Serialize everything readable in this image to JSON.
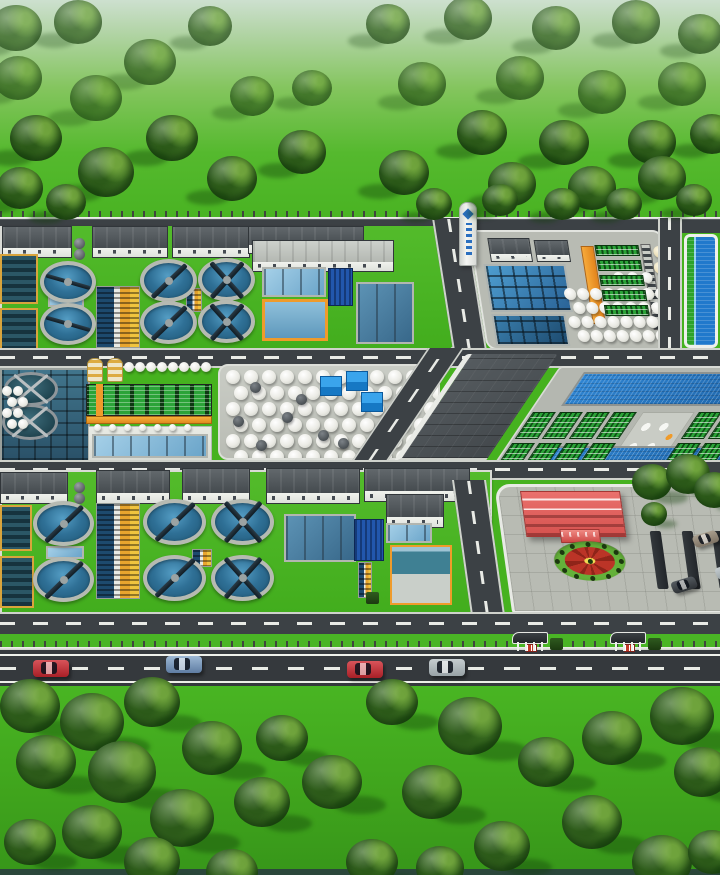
{
  "subject": "aerial 3d rendering of a wastewater treatment plant campus with tree belts, roads and vehicles",
  "colors": {
    "grass": "#46b21f",
    "grass_haze": "#cde0cf",
    "tree_dark": "#27511a",
    "tree_mid": "#4b8527",
    "tree_light": "#6fa33c",
    "road": "#3c4145",
    "road_dark": "#35393d",
    "curb": "#d6d8d3",
    "lane_marking": "#eef0ea",
    "water_clarifier": "#2f7096",
    "water_mid": "#6aa4c9",
    "water_teal": "#2a5168",
    "water_navy": "#2257ac",
    "rim": "#b6bab2",
    "bridge": "#101c24",
    "wall": "#eceee9",
    "roof_dark": "#454b4f",
    "roof_light": "#b4b8b2",
    "orange": "#ef9b2b",
    "yellow": "#f0c43e",
    "rack_green": "#2ba338",
    "tank": "#f3f3ee",
    "cube_blue": "#1678c4",
    "red_building": "#d6524f",
    "plaza": "#b8bbb3",
    "flower_red": "#bb3427",
    "flower_yellow": "#f0dc55",
    "flower_green": "#64b13a",
    "reservoir": "#2079cc",
    "reservoir_green": "#2ca32c",
    "car_red": "#a81f26",
    "car_blue": "#5f7da3",
    "car_silver": "#98a2a6",
    "car_dark": "#2e3236",
    "car_taupe": "#7e7365"
  },
  "scene": {
    "trees": [
      [
        16,
        28,
        26,
        "sw"
      ],
      [
        78,
        22,
        24,
        "sw"
      ],
      [
        210,
        26,
        22,
        "sw"
      ],
      [
        150,
        62,
        26,
        "sw"
      ],
      [
        18,
        78,
        24,
        "sw"
      ],
      [
        96,
        98,
        26,
        "sw"
      ],
      [
        252,
        96,
        22,
        "sw"
      ],
      [
        312,
        88,
        20,
        "sw"
      ],
      [
        36,
        138,
        26,
        "sw"
      ],
      [
        172,
        138,
        26,
        "sw"
      ],
      [
        106,
        172,
        28,
        "sw"
      ],
      [
        302,
        152,
        24,
        "sw"
      ],
      [
        232,
        178,
        25,
        "sw"
      ],
      [
        20,
        188,
        23,
        "sw"
      ],
      [
        66,
        202,
        20,
        "sw"
      ],
      [
        388,
        24,
        22,
        "sw"
      ],
      [
        468,
        18,
        24,
        "sw"
      ],
      [
        556,
        28,
        24,
        "sw"
      ],
      [
        636,
        22,
        24,
        "sw"
      ],
      [
        700,
        34,
        22,
        "sw"
      ],
      [
        422,
        84,
        24,
        "sw"
      ],
      [
        520,
        78,
        24,
        "sw"
      ],
      [
        602,
        92,
        24,
        "sw"
      ],
      [
        682,
        84,
        24,
        "sw"
      ],
      [
        482,
        132,
        25,
        "sw"
      ],
      [
        564,
        142,
        25,
        "sw"
      ],
      [
        652,
        142,
        24,
        "sw"
      ],
      [
        712,
        134,
        22,
        "sw"
      ],
      [
        404,
        172,
        25,
        "sw"
      ],
      [
        512,
        184,
        24,
        "sw"
      ],
      [
        592,
        188,
        24,
        "sw"
      ],
      [
        662,
        178,
        24,
        "sw"
      ],
      [
        434,
        204,
        18,
        "sw"
      ],
      [
        500,
        200,
        18,
        "sw"
      ],
      [
        562,
        204,
        18,
        "sw"
      ],
      [
        624,
        204,
        18,
        "sw"
      ],
      [
        694,
        200,
        18,
        "sw"
      ],
      [
        652,
        482,
        20,
        "se"
      ],
      [
        688,
        474,
        22,
        "se"
      ],
      [
        714,
        490,
        20,
        "se"
      ],
      [
        654,
        514,
        13,
        "se"
      ],
      [
        30,
        706,
        30,
        "se"
      ],
      [
        92,
        722,
        32,
        "se"
      ],
      [
        152,
        702,
        28,
        "se"
      ],
      [
        46,
        762,
        30,
        "se"
      ],
      [
        122,
        772,
        34,
        "se"
      ],
      [
        212,
        748,
        30,
        "se"
      ],
      [
        282,
        738,
        26,
        "se"
      ],
      [
        182,
        818,
        32,
        "se"
      ],
      [
        92,
        832,
        30,
        "se"
      ],
      [
        262,
        802,
        28,
        "se"
      ],
      [
        332,
        782,
        30,
        "se"
      ],
      [
        30,
        842,
        26,
        "se"
      ],
      [
        152,
        862,
        28,
        "se"
      ],
      [
        392,
        702,
        26,
        "se"
      ],
      [
        470,
        726,
        32,
        "se"
      ],
      [
        432,
        792,
        30,
        "se"
      ],
      [
        546,
        762,
        28,
        "se"
      ],
      [
        612,
        738,
        30,
        "se"
      ],
      [
        682,
        716,
        32,
        "se"
      ],
      [
        702,
        772,
        28,
        "se"
      ],
      [
        592,
        822,
        30,
        "se"
      ],
      [
        502,
        846,
        28,
        "se"
      ],
      [
        662,
        862,
        30,
        "se"
      ],
      [
        372,
        862,
        26,
        "se"
      ],
      [
        712,
        852,
        24,
        "se"
      ],
      [
        232,
        872,
        26,
        "se"
      ],
      [
        440,
        868,
        24,
        "se"
      ]
    ],
    "clarifiers": [
      [
        40,
        261,
        56,
        42,
        "h"
      ],
      [
        40,
        303,
        56,
        42,
        "h"
      ],
      [
        140,
        259,
        57,
        43,
        "diag"
      ],
      [
        140,
        301,
        57,
        43,
        "diag"
      ],
      [
        198,
        258,
        57,
        43,
        "x"
      ],
      [
        198,
        300,
        57,
        43,
        "x"
      ],
      [
        33,
        501,
        61,
        45,
        "diag"
      ],
      [
        33,
        557,
        61,
        45,
        "diag"
      ],
      [
        143,
        499,
        63,
        46,
        "diag"
      ],
      [
        143,
        555,
        63,
        46,
        "diag"
      ],
      [
        211,
        499,
        63,
        46,
        "x"
      ],
      [
        211,
        555,
        63,
        46,
        "x"
      ]
    ],
    "digesters": [
      [
        4,
        372,
        54,
        34
      ],
      [
        2,
        404,
        56,
        36
      ]
    ],
    "tank_grids": [
      {
        "parent": "tank-farm",
        "x": 6,
        "y": 4,
        "cols": 12,
        "rows": 6,
        "dx": 18,
        "dy": 16,
        "d": 14,
        "st": 8
      },
      {
        "parent": "process-yard",
        "x": 84,
        "y": 56,
        "cols": 8,
        "rows": 4,
        "dx": 13,
        "dy": 14,
        "d": 12,
        "st": 7
      },
      {
        "parent": "process-yard",
        "x": 136,
        "y": 40,
        "cols": 3,
        "rows": 1,
        "dx": 14,
        "dy": 0,
        "d": 11,
        "st": 0
      },
      {
        "parent": "scene",
        "x": 124,
        "y": 362,
        "cols": 8,
        "rows": 1,
        "dx": 11,
        "dy": 0,
        "d": 10,
        "st": 0
      },
      {
        "parent": "scene",
        "x": 2,
        "y": 386,
        "cols": 2,
        "rows": 4,
        "dx": 11,
        "dy": 11,
        "d": 10,
        "st": 5
      },
      {
        "parent": "scene",
        "x": 94,
        "y": 424,
        "cols": 7,
        "rows": 1,
        "dx": 15,
        "dy": 0,
        "d": 7,
        "st": 0
      }
    ],
    "rack_grids": [
      {
        "parent": "process-yard",
        "x": 122,
        "y": 13,
        "cols": 1,
        "rows": 5,
        "dx": 0,
        "dy": 15,
        "w": 44,
        "h": 11
      },
      {
        "parent": "mbr-block",
        "x": 2,
        "y": 44,
        "cols": 4,
        "rows": 2,
        "dx": 27,
        "dy": 31,
        "w": 23,
        "h": 27
      },
      {
        "parent": "mbr-block",
        "x": 168,
        "y": 44,
        "cols": 3,
        "rows": 2,
        "dx": 27,
        "dy": 31,
        "w": 23,
        "h": 27
      }
    ],
    "cubes": [
      [
        320,
        376
      ],
      [
        346,
        371
      ],
      [
        361,
        392
      ]
    ],
    "dark_tanks": [
      [
        250,
        382
      ],
      [
        282,
        412
      ],
      [
        318,
        430
      ],
      [
        256,
        440
      ],
      [
        296,
        394
      ],
      [
        338,
        438
      ],
      [
        233,
        416
      ]
    ],
    "domes": {
      "parent": "process-yard",
      "pts": [
        [
          180,
          14
        ],
        [
          183,
          24
        ],
        [
          178,
          30
        ]
      ]
    },
    "silos": [
      [
        87,
        358
      ],
      [
        107,
        358
      ]
    ],
    "spheres": [
      [
        74,
        238
      ],
      [
        74,
        249
      ],
      [
        74,
        482
      ],
      [
        74,
        493
      ]
    ],
    "shelters": [
      512,
      610
    ],
    "hedges": [
      [
        146,
        44
      ],
      [
        178,
        44
      ],
      [
        208,
        44
      ]
    ],
    "cars_road": [
      [
        33,
        660,
        "red"
      ],
      [
        166,
        656,
        "blue"
      ],
      [
        347,
        661,
        "red"
      ],
      [
        429,
        659,
        "silver"
      ]
    ],
    "cars_parking": [
      [
        160,
        92,
        "dark"
      ],
      [
        188,
        46,
        "taupe"
      ],
      [
        206,
        78,
        "silver"
      ]
    ]
  }
}
